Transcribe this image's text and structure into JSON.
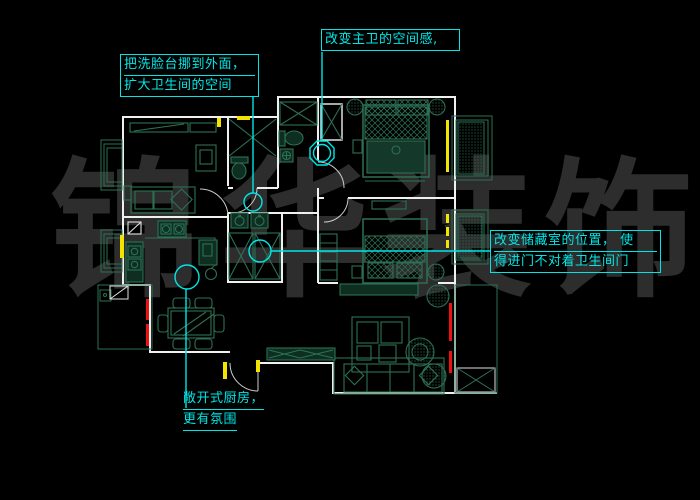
{
  "app": {
    "type": "cad-floorplan-view",
    "background": "#000000"
  },
  "watermark": {
    "text": "锦华装饰",
    "chars": [
      "锦",
      "华",
      "装",
      "饰"
    ],
    "color": "#2d2d2d"
  },
  "annotations": {
    "basin": {
      "lines": [
        "把洗脸台挪到外面，",
        "扩大卫生间的空间"
      ]
    },
    "masterbath": {
      "lines": [
        "改变主卫的空间感,"
      ]
    },
    "storage": {
      "lines": [
        "改变储藏室的位置， 使",
        "得进门不对着卫生间门"
      ]
    },
    "kitchen": {
      "lines": [
        "敞开式厨房，",
        "更有氛围"
      ]
    }
  },
  "colors": {
    "wall": "#f0f0f0",
    "furniture": "#2d7055",
    "annotation": "#00e6e6",
    "window_mark": "#f2e300",
    "highlight_mark": "#ee1111",
    "watermark": "#2d2d2d"
  }
}
